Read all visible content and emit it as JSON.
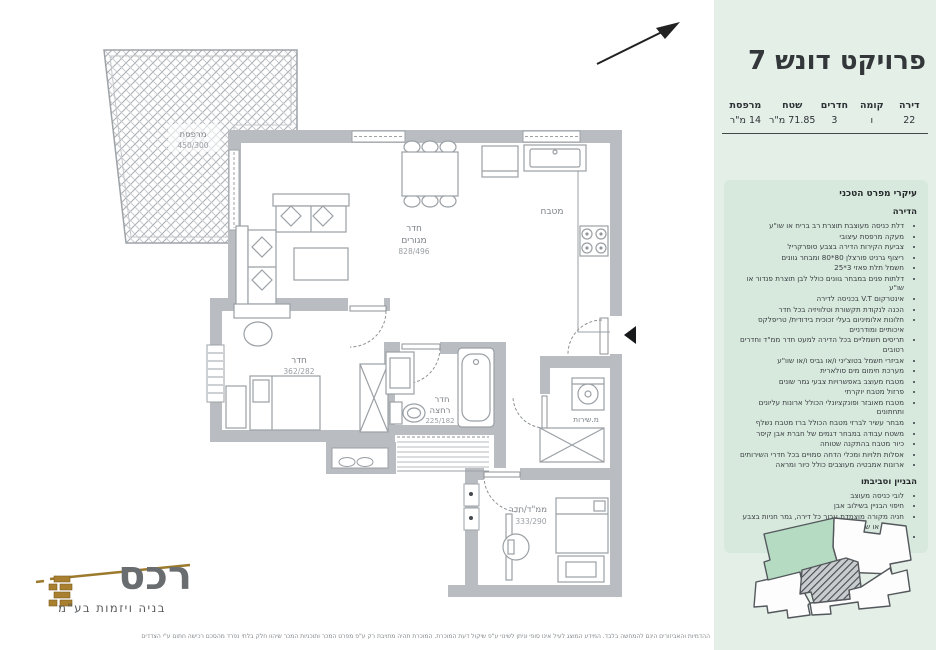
{
  "panel": {
    "bg_color": "#e4efe8",
    "box_color": "#d7e8dd",
    "title": "פרויקט דונש 7",
    "table": {
      "headers": [
        "דירה",
        "קומה",
        "חדרים",
        "שטח",
        "מרפסת"
      ],
      "values": [
        "22",
        "ו",
        "3",
        "71.85 מ\"ר",
        "14 מ\"ר"
      ]
    },
    "spec": {
      "title": "עיקרי מפרט הטכני",
      "sections": [
        {
          "heading": "הדירה",
          "items": [
            "דלת כניסה מעוצבת תוצרת רב בריח או שו\"ע",
            "מעקה מרפסת עיצובי",
            "צביעת הקירות הדירה בצבע סופרקריל",
            "ריצוף גרניט פורצלן 80*80 ומבחר גוונים",
            "חשמל תלת פאזי 3*25",
            "דלתות פנים במבחר גוונים כולל לבן תוצרת פנדור או שו\"ע",
            "אינטרקום V.T בכניסה לדירה",
            "הכנה לנקודת תקשורת וטלוויזיה בכל חדר",
            "חלונות אלומיניום בעלי זכוכית בידודית/ טריפלקס איכותיים ומודרניים",
            "תריסים חשמליים בכל הדירה למעט חדר ממ\"ד וחדרים רטובים",
            "אביזרי חשמל בטוצ'יני ו/או גביס ו/או שוו\"ע",
            "מערכת חימום מים סולארית",
            "מטבח מעוצב באפשרויות צבעי גמר שונים",
            "פרזול מטבח יוקרתי",
            "מטבח מאובזר ופונקציונלי הכולל ארונות עליונים ותחתונים",
            "מבחר עשיר לברזי מטבח הכולל ברז מטבח נשלף",
            "משטח עבודה במבחר דגמים של חברת אבן קיסר",
            "כיור מטבח בהתקנה שטוחה",
            "אסלות תלויות ומכלי הדחה סמויים בכל חדרי השירותים",
            "ארונות אמבטיה מעוצבים כולל כיור ומראה"
          ]
        },
        {
          "heading": "הבניין וסביבתו",
          "items": [
            "לובי כניסה מעוצב",
            "חיפוי הבניין בשילוב אבן",
            "חניה מקורה מוצמדת עבור כל דירה, גמר חניות בצבע אפוקסי או שוו\"ע",
            "לובי קומתי הכולל חיפויים עד גובה תקרה"
          ]
        }
      ]
    },
    "keyplan": {
      "highlight_color": "#b5dcc3"
    }
  },
  "plan": {
    "rooms": {
      "balcony": {
        "line1": "מרפסת",
        "dims": "450/300"
      },
      "living": {
        "line1": "חדר",
        "line2": "מגורים",
        "dims": "828/496"
      },
      "kitchen": {
        "line1": "מטבח"
      },
      "bedroom": {
        "line1": "חדר",
        "dims": "362/282"
      },
      "bath": {
        "line1": "חדר",
        "line2": "רחצה",
        "dims": "225/182"
      },
      "service": {
        "line1": "מ.שירות"
      },
      "mamad": {
        "line1": "ממ\"ד/חדר",
        "dims": "333/290"
      }
    }
  },
  "logo": {
    "name": "רכס",
    "tagline": "בניה ויזמות בע\"מ",
    "gold": "#a8802f"
  },
  "disclaimer": "ההדמיות והאביזורים הינם להמחשה בלבד. המידע המוצג לעיל אינו סופי וניתן לשינוי ע\"פ שיקול דעת המוכרת. המוכרת תהיה מחויבת רק ע\"פ מפרט המכר ותוכניות המכר שיהוו חלק בלתי נפרד מהסכם רכישה חתום ע\"י הצדדים"
}
